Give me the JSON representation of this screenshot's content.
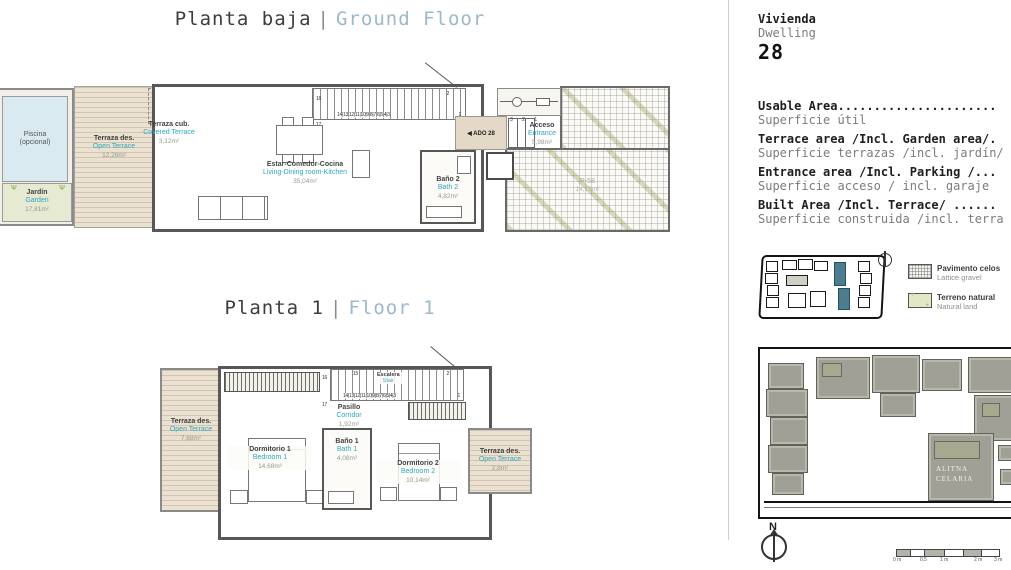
{
  "titles": {
    "ground": {
      "es": "Planta baja",
      "sep": "|",
      "en": "Ground Floor"
    },
    "floor1": {
      "es": "Planta 1",
      "sep": "|",
      "en": "Floor 1"
    }
  },
  "ground_floor": {
    "piscina": {
      "name": "Piscina",
      "note": "(opcional)"
    },
    "jardin": {
      "es": "Jardín",
      "en": "Garden",
      "area": "17,81m²"
    },
    "open_terrace": {
      "es": "Terraza des.",
      "en": "Open Terrace",
      "area": "12,26m²"
    },
    "covered_terrace": {
      "es": "Terraza cub.",
      "en": "Covered Terrace",
      "area": "3,12m²"
    },
    "depuradora": {
      "line1": "Depuradora",
      "line2": "piscina"
    },
    "living": {
      "es": "Estar-Comedor-Cocina",
      "en": "Living-Dining room-Kitchen",
      "area": "35,04m²"
    },
    "bath2": {
      "es": "Baño 2",
      "en": "Bath 2",
      "area": "4,82m²"
    },
    "entrance": {
      "es": "Acceso",
      "en": "Entrance",
      "area": "5,98m²"
    },
    "parking": {
      "code": "P-58",
      "area": "14,13m²"
    },
    "door_label": "◀ ADO 28",
    "stairs": {
      "row": "14|13|12|11|10|9|8|7|6|5|4|3",
      "n16": "16",
      "n17": "17",
      "n2": "2",
      "n1": "1"
    },
    "entry_steps": "3 2 1"
  },
  "floor_1": {
    "open_terrace_left": {
      "es": "Terraza des.",
      "en": "Open Terrace",
      "area": "7,68m²"
    },
    "bedroom1": {
      "es": "Dormitorio 1",
      "en": "Bedroom 1",
      "area": "14,68m²"
    },
    "stair": {
      "es": "Escalera",
      "en": "Stair"
    },
    "corridor": {
      "es": "Pasillo",
      "en": "Corridor",
      "area": "1,92m²"
    },
    "bath1": {
      "es": "Baño 1",
      "en": "Bath 1",
      "area": "4,08m²"
    },
    "bedroom2": {
      "es": "Dormitorio 2",
      "en": "Bedroom 2",
      "area": "10,14m²"
    },
    "open_terrace_right": {
      "es": "Terraza des.",
      "en": "Open Terrace",
      "area": "2,8m²"
    },
    "stairs": {
      "row": "14|13|12|11|10|9|8|7|6|5|4|3",
      "n15": "15",
      "n16": "16",
      "n17": "17",
      "n2": "2",
      "n1": "1"
    }
  },
  "info_panel": {
    "dwelling_es": "Vivienda",
    "dwelling_en": "Dwelling",
    "dwelling_number": "28",
    "areas": [
      {
        "en": "Usable Area......................",
        "es": "Superficie útil"
      },
      {
        "en": "Terrace area /Incl. Garden area/.",
        "es": "Superficie terrazas /incl. jardín/"
      },
      {
        "en": "Entrance area /Incl. Parking /...",
        "es": "Superficie acceso / incl. garaje"
      },
      {
        "en": "Built Area /Incl. Terrace/ ......",
        "es": "Superficie construida /incl. terra"
      }
    ],
    "legend": [
      {
        "title": "Pavimento celos",
        "subtitle": "Lattice gravel"
      },
      {
        "title": "Terreno natural",
        "subtitle": "Natural land"
      }
    ],
    "site_labels": {
      "line1": "ALITNA",
      "line2": "CELARIA"
    },
    "compass_label": "N",
    "scale_ticks": [
      "0 m",
      "0,5",
      "1 m",
      "2 m",
      "3 m"
    ]
  },
  "colors": {
    "accent_teal": "#2fa6c0",
    "title_blue": "#9cb9c9",
    "deck_beige": "#eae1d1",
    "garden_green": "#e7ead2",
    "pool_blue": "#d9ebf1",
    "wall_gray": "#575757"
  }
}
